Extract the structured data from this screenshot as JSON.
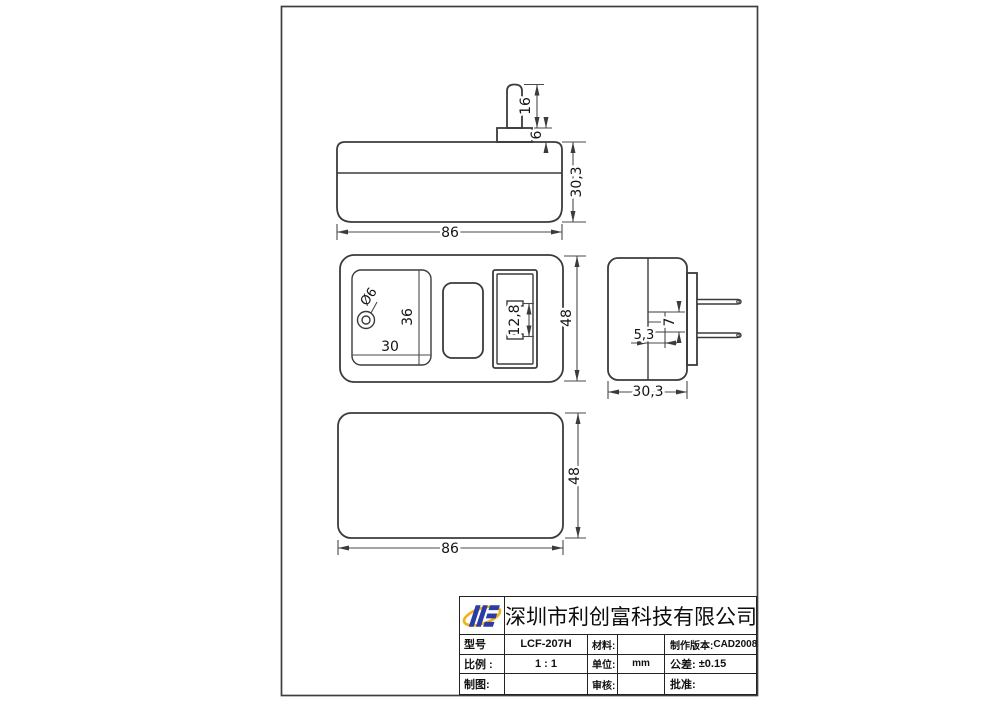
{
  "dims": {
    "top_pin_length": "16",
    "top_pin_base": "6",
    "top_body_height": "30,3",
    "top_body_width": "86",
    "front_jack_diameter": "Ø6",
    "front_panel_height": "36",
    "front_panel_width": "30",
    "front_slot_spacing": "12,8",
    "front_body_height": "48",
    "side_notch_height": "7",
    "side_notch_width": "5,3",
    "side_body_width": "30,3",
    "back_body_height": "48",
    "back_body_width": "86"
  },
  "title_block": {
    "company_name": "深圳市利创富科技有限公司",
    "model_label": "型号",
    "model_value": "LCF-207H",
    "material_label": "材料:",
    "material_value": "",
    "version_label": "制作版本:",
    "version_value": "CAD2008",
    "scale_label": "比例 :",
    "scale_value": "1 : 1",
    "unit_label": "单位:",
    "unit_value": "mm",
    "tolerance_label": "公差:",
    "tolerance_value": "±0.15",
    "drawn_label": "制图:",
    "drawn_value": "",
    "check_label": "审核:",
    "check_value": "",
    "approve_label": "批准:",
    "approve_value": ""
  },
  "logo_colors": {
    "blue": "#2b3ca6",
    "gold": "#f0b417"
  }
}
